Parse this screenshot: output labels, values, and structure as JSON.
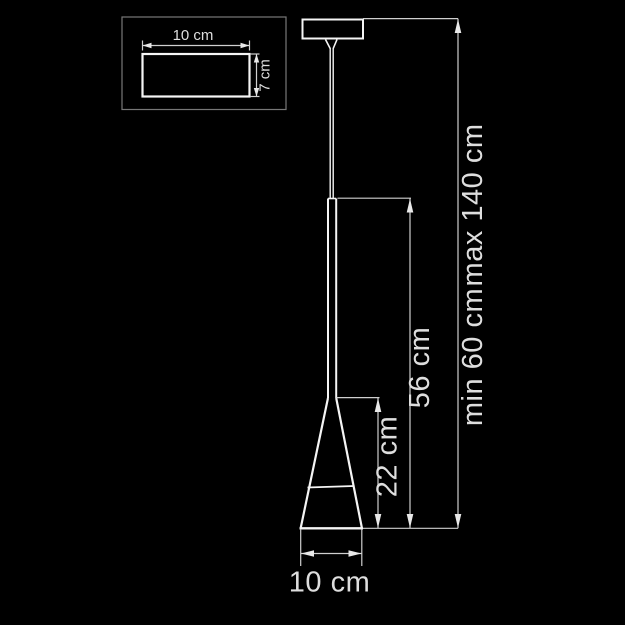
{
  "diagram": {
    "kind": "pendant-lamp-dimension-drawing",
    "inset": {
      "width_label": "10 cm",
      "height_label": "7 cm"
    },
    "dimensions": {
      "shade_height_label": "22 cm",
      "fixed_section_label": "56 cm",
      "min_height_label": "min 60 cm",
      "max_height_label": "max 140 cm",
      "shade_diameter_label": "10 cm"
    },
    "colors": {
      "background": "#000000",
      "line": "#f5f5f5",
      "dimension_line": "#cfcfcf",
      "label_text": "#dedede",
      "inset_border": "#777777"
    }
  }
}
